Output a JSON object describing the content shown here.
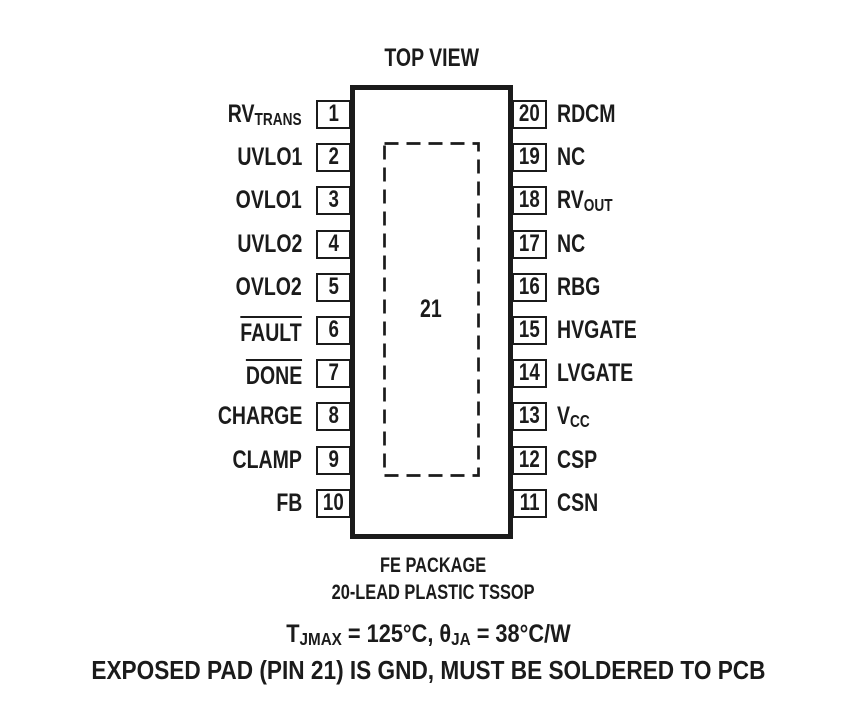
{
  "title": "TOP VIEW",
  "package": {
    "center_label": "21",
    "name_line1": "FE PACKAGE",
    "name_line2": "20-LEAD PLASTIC TSSOP"
  },
  "pins": {
    "left": [
      {
        "num": "1",
        "base": "RV",
        "sub": "TRANS"
      },
      {
        "num": "2",
        "base": "UVLO1"
      },
      {
        "num": "3",
        "base": "OVLO1"
      },
      {
        "num": "4",
        "base": "UVLO2"
      },
      {
        "num": "5",
        "base": "OVLO2"
      },
      {
        "num": "6",
        "base": "FAULT",
        "overline": true
      },
      {
        "num": "7",
        "base": "DONE",
        "overline": true
      },
      {
        "num": "8",
        "base": "CHARGE"
      },
      {
        "num": "9",
        "base": "CLAMP"
      },
      {
        "num": "10",
        "base": "FB"
      }
    ],
    "right": [
      {
        "num": "20",
        "base": "RDCM"
      },
      {
        "num": "19",
        "base": "NC"
      },
      {
        "num": "18",
        "base": "RV",
        "sub": "OUT"
      },
      {
        "num": "17",
        "base": "NC"
      },
      {
        "num": "16",
        "base": "RBG"
      },
      {
        "num": "15",
        "base": "HVGATE"
      },
      {
        "num": "14",
        "base": "LVGATE"
      },
      {
        "num": "13",
        "base": "V",
        "sub": "CC"
      },
      {
        "num": "12",
        "base": "CSP"
      },
      {
        "num": "11",
        "base": "CSN"
      }
    ]
  },
  "notes": {
    "line1": {
      "t_base": "T",
      "t_sub": "JMAX",
      "mid": " = 125°C, ",
      "theta": "θ",
      "theta_sub": "JA",
      "tail": " = 38°C/W"
    },
    "line2": "EXPOSED PAD (PIN 21) IS GND, MUST BE SOLDERED TO PCB"
  },
  "colors": {
    "ink": "#1b1b1b",
    "background": "#ffffff"
  }
}
